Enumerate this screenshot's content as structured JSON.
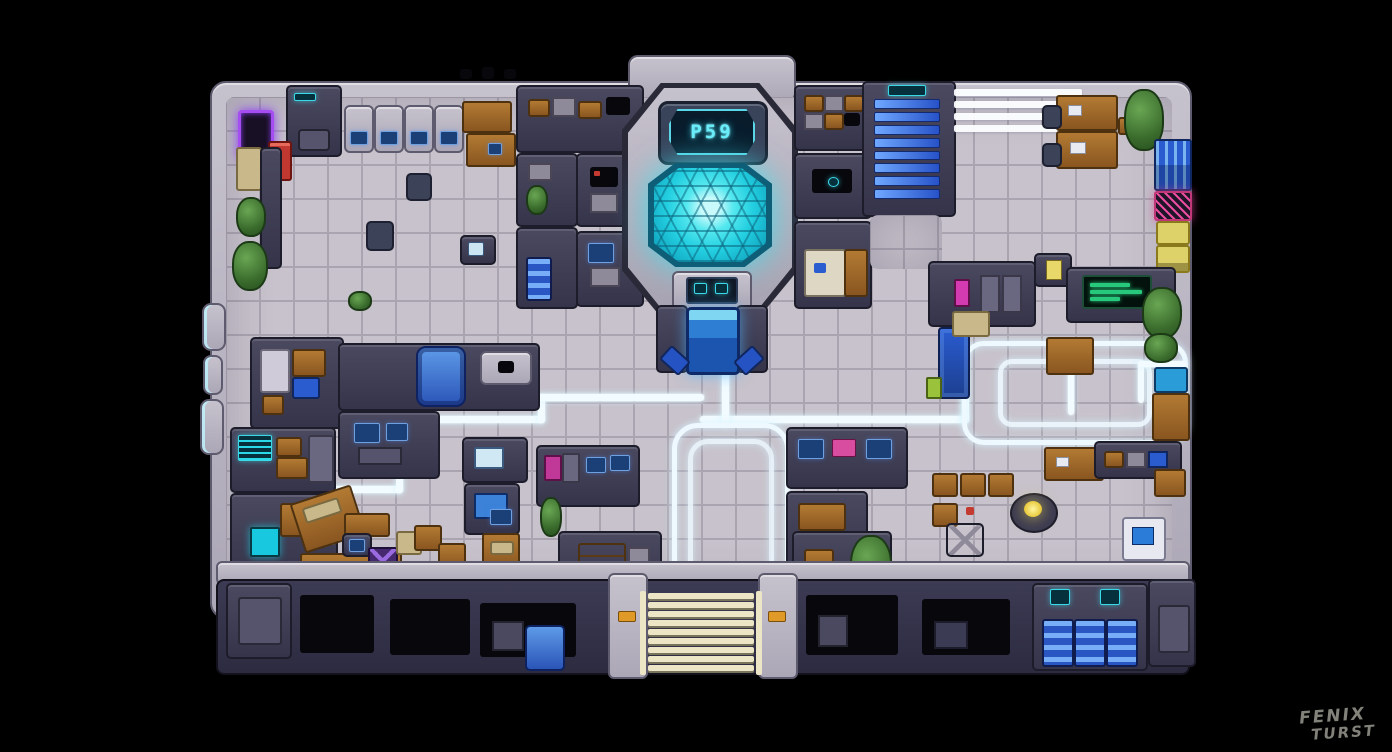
{
  "scene": {
    "description": "top-down pixel-art sci-fi station floor plan on black void",
    "background": "#000000"
  },
  "central_chamber": {
    "display_text": "P59"
  },
  "watermark": {
    "line1": "FENIX",
    "line2": "TURST"
  },
  "palette": {
    "floor": "#c7c2cb",
    "grout": "#aaa4b0",
    "outer_wall": "#b4afbb",
    "dark_wall": "#3e3d52",
    "glow_path": "#eef9ff",
    "pool_cyan": "#35dfe8",
    "stair_blue": "#3b7bf0",
    "locker_blue": "#2a5cd0",
    "wood": "#9a6226",
    "steps_cream": "#ece5c6",
    "accent_red": "#c43a30",
    "accent_purple": "#a44df0",
    "accent_magenta": "#d43bb0",
    "accent_yellow": "#e8dd6a"
  }
}
